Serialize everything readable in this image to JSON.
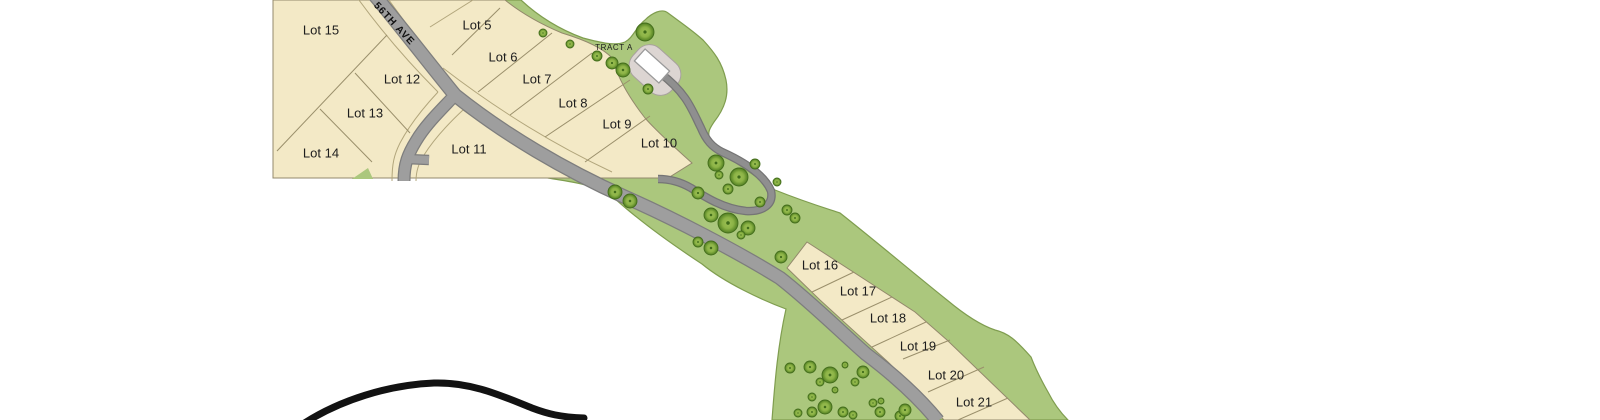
{
  "page": {
    "background": "#ffffff",
    "description": "Subdivision plat site map"
  },
  "map": {
    "road_labels": [
      {
        "label": "56TH AVE",
        "x": 394,
        "y": 24,
        "rotate": 47
      }
    ],
    "tract_label": {
      "label": "TRACT A",
      "x": 614,
      "y": 48
    },
    "lot_labels": [
      {
        "label": "Lot 15",
        "x": 321,
        "y": 31
      },
      {
        "label": "Lot 5",
        "x": 477,
        "y": 26
      },
      {
        "label": "Lot 6",
        "x": 503,
        "y": 58
      },
      {
        "label": "Lot 12",
        "x": 402,
        "y": 80
      },
      {
        "label": "Lot 7",
        "x": 537,
        "y": 80
      },
      {
        "label": "Lot 8",
        "x": 573,
        "y": 104
      },
      {
        "label": "Lot 13",
        "x": 365,
        "y": 114
      },
      {
        "label": "Lot 9",
        "x": 617,
        "y": 125
      },
      {
        "label": "Lot 10",
        "x": 659,
        "y": 144
      },
      {
        "label": "Lot 11",
        "x": 469,
        "y": 150
      },
      {
        "label": "Lot 14",
        "x": 321,
        "y": 154
      },
      {
        "label": "Lot 16",
        "x": 820,
        "y": 266
      },
      {
        "label": "Lot 17",
        "x": 858,
        "y": 292
      },
      {
        "label": "Lot 18",
        "x": 888,
        "y": 319
      },
      {
        "label": "Lot 19",
        "x": 918,
        "y": 347
      },
      {
        "label": "Lot 20",
        "x": 946,
        "y": 376
      },
      {
        "label": "Lot 21",
        "x": 974,
        "y": 403
      }
    ],
    "colors": {
      "lot_fill": "#f3e9c6",
      "lot_line": "#9a8f6b",
      "parcel_stroke": "#93896c",
      "green": "#abc77d",
      "green_stroke": "#7f9d4f",
      "road_fill": "#9e9e9e",
      "road_casing": "#7d7d7d",
      "driveway_fill": "#8f8f8f",
      "driveway_casing": "#757575",
      "row_line": "#b2a67c",
      "tract_pad": "#dcd5d2",
      "tract_pad_stroke": "#a8a19e",
      "building_fill": "#ffffff",
      "building_stroke": "#9a9a9a",
      "tree_edge": "#446e1c",
      "hill_line": "#121212",
      "label_text": "#1d1d1d"
    },
    "trees": [
      [
        543,
        33,
        4
      ],
      [
        570,
        44,
        4
      ],
      [
        597,
        56,
        5
      ],
      [
        612,
        63,
        6
      ],
      [
        623,
        70,
        7
      ],
      [
        645,
        32,
        9
      ],
      [
        648,
        89,
        5
      ],
      [
        615,
        192,
        7
      ],
      [
        630,
        201,
        7
      ],
      [
        698,
        193,
        6
      ],
      [
        716,
        163,
        8
      ],
      [
        719,
        175,
        4
      ],
      [
        739,
        177,
        9
      ],
      [
        728,
        189,
        5
      ],
      [
        755,
        164,
        5
      ],
      [
        777,
        182,
        4
      ],
      [
        760,
        202,
        5
      ],
      [
        711,
        215,
        7
      ],
      [
        728,
        223,
        10
      ],
      [
        748,
        228,
        7
      ],
      [
        741,
        235,
        4
      ],
      [
        787,
        210,
        5
      ],
      [
        795,
        218,
        5
      ],
      [
        698,
        242,
        5
      ],
      [
        711,
        248,
        7
      ],
      [
        781,
        257,
        6
      ],
      [
        790,
        368,
        5
      ],
      [
        810,
        367,
        6
      ],
      [
        830,
        375,
        8
      ],
      [
        845,
        365,
        3
      ],
      [
        863,
        372,
        6
      ],
      [
        855,
        382,
        4
      ],
      [
        820,
        382,
        4
      ],
      [
        835,
        390,
        3
      ],
      [
        812,
        397,
        4
      ],
      [
        825,
        407,
        7
      ],
      [
        843,
        412,
        5
      ],
      [
        873,
        403,
        4
      ],
      [
        881,
        401,
        3
      ],
      [
        812,
        412,
        5
      ],
      [
        798,
        413,
        4
      ],
      [
        853,
        415,
        4
      ],
      [
        880,
        412,
        5
      ],
      [
        900,
        416,
        5
      ],
      [
        905,
        410,
        6
      ]
    ]
  }
}
